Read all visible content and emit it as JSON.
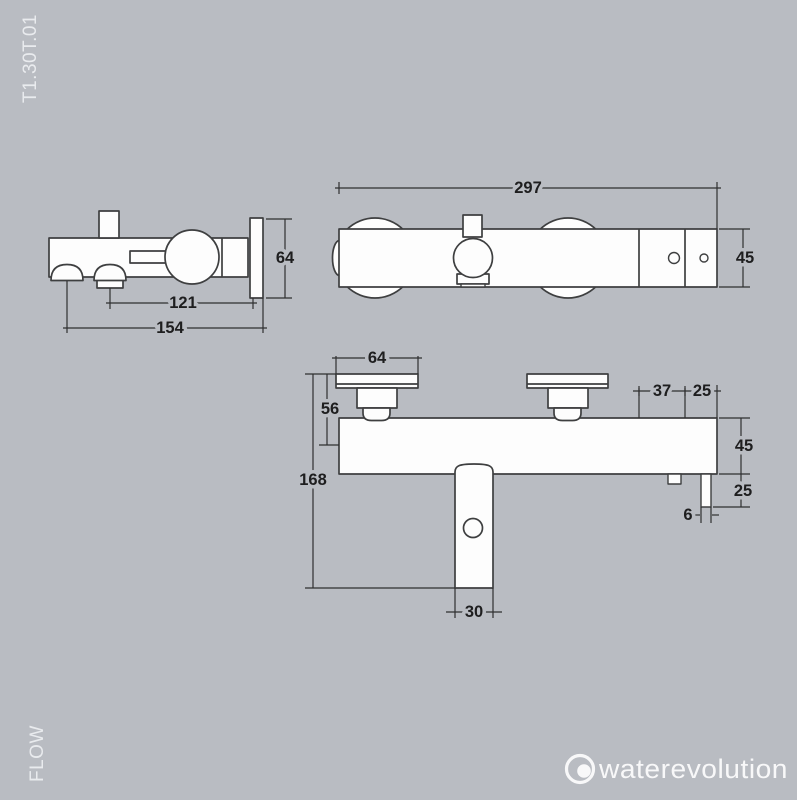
{
  "sheet": {
    "product_code": "T1.30T.01",
    "side_label": "FLOW"
  },
  "brand": {
    "logo_text": "waterevolution"
  },
  "colors": {
    "background": "#b9bcc2",
    "shape_outline": "#3e3f40",
    "shape_fill": "#fdfdfd",
    "dimension_line": "#2f2f30",
    "dimension_text": "#1e1e1f",
    "light_text": "#e9ebee",
    "logo_color": "#f8f8f9"
  },
  "views": {
    "side": {
      "dims": {
        "wall_plate_height": "64",
        "shower_outlet_to_wall": "121",
        "spout_outlet_to_wall": "154"
      }
    },
    "top": {
      "dims": {
        "total_width": "297",
        "body_depth": "45"
      }
    },
    "front": {
      "dims": {
        "flange_width": "64",
        "wall_to_body_axis": "56",
        "total_height": "168",
        "spout_width": "30",
        "screw_spacing": "37",
        "screw_to_edge": "25",
        "body_height": "45",
        "outlet_drop": "25",
        "outlet_width": "6"
      }
    }
  }
}
